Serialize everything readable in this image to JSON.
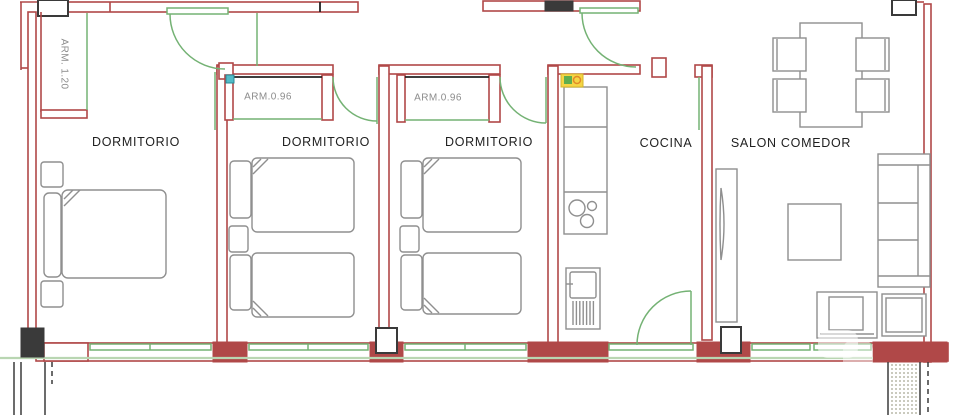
{
  "drawing": {
    "type": "apartment-floor-plan",
    "rooms": {
      "bedroom_1": {
        "label": "DORMITORIO"
      },
      "bedroom_2": {
        "label": "DORMITORIO"
      },
      "bedroom_3": {
        "label": "DORMITORIO"
      },
      "kitchen": {
        "label": "COCINA"
      },
      "living_dining": {
        "label": "SALON COMEDOR"
      }
    },
    "closets": {
      "main": {
        "label": "ARM. 1.20"
      },
      "bedroom_2": {
        "label": "ARM.0.96"
      },
      "bedroom_3": {
        "label": "ARM.0.96"
      }
    }
  },
  "colors": {
    "background": "#ffffff",
    "wall": "#b04848",
    "door_green": "#74b274",
    "window_sill": "#b9d6b2",
    "furniture": "#8f8f8f",
    "pillar": "#3a3a3a",
    "label_dark": "#1f1f1f",
    "label_gray": "#8c8c8c",
    "marker_cyan": "#52bcc8",
    "marker_yellow": "#f5d544",
    "marker_green": "#5fae4e",
    "marker_orange": "#e08a28"
  }
}
